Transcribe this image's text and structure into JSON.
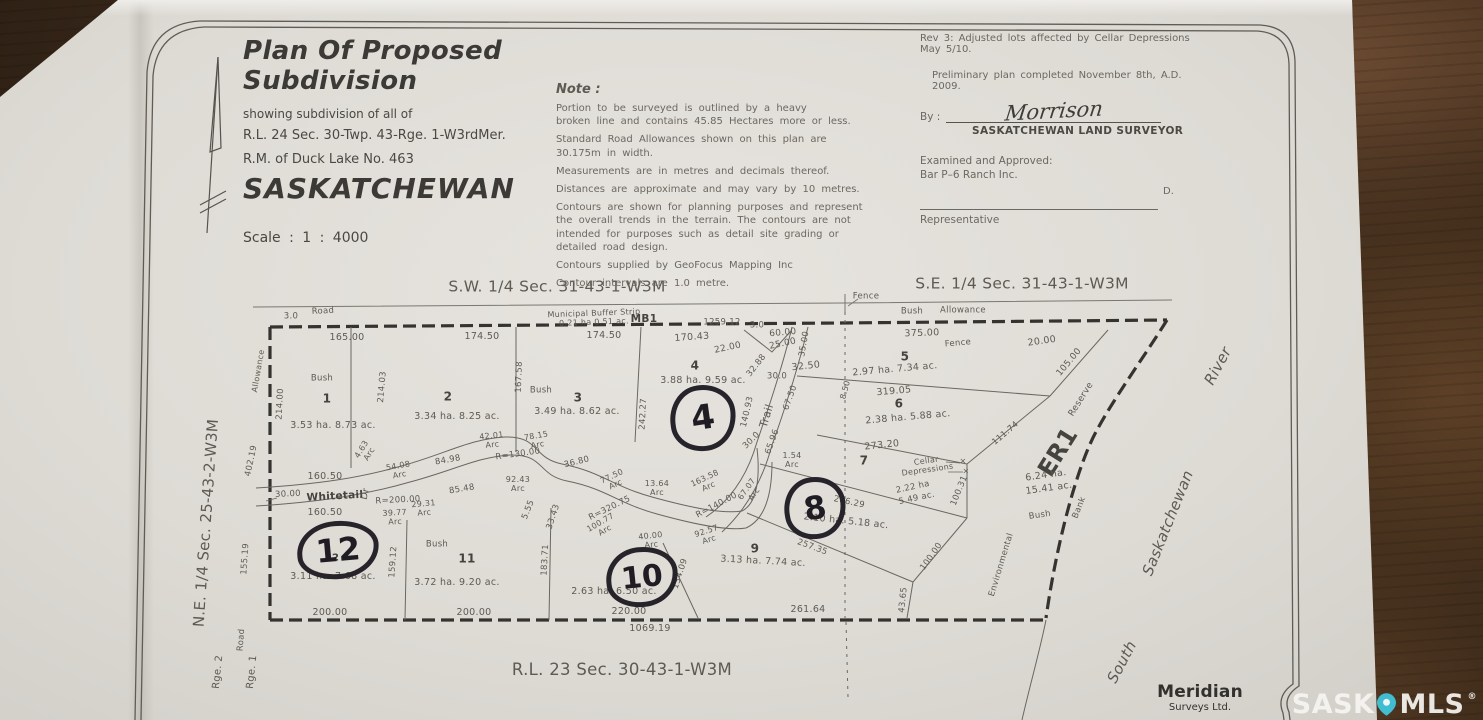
{
  "title_block": {
    "title": "Plan Of Proposed Subdivision",
    "line1": "showing subdivision of all of",
    "line2": "R.L. 24 Sec. 30-Twp. 43-Rge. 1-W3rdMer.",
    "line3": "R.M. of Duck Lake No. 463",
    "province": "SASKATCHEWAN",
    "scale": "Scale :  1 : 4000"
  },
  "notes": {
    "heading": "Note :",
    "items": [
      "Portion to be surveyed is outlined by a heavy\nbroken line and contains 45.85 Hectares more or less.",
      "Standard Road Allowances shown on this plan are\n30.175m in width.",
      "Measurements are in metres and decimals thereof.",
      "Distances are approximate and may vary by 10 metres.",
      "Contours are shown for planning purposes and represent\nthe overall trends in the terrain.  The contours are not\nintended for purposes such as detail site grading or\ndetailed road design.",
      "Contours supplied by GeoFocus Mapping Inc",
      "Contour intervals are 1.0 metre."
    ]
  },
  "approval": {
    "rev_note": "Rev 3:  Adjusted lots affected by Cellar Depressions May 5/10.",
    "prelim_note": "Preliminary plan completed November 8th, A.D. 2009.",
    "by_label": "By :",
    "signature": "Morrison",
    "surveyor_title": "SASKATCHEWAN LAND SURVEYOR",
    "examined": "Examined and Approved:\nBar P–6 Ranch Inc.",
    "representative_label": "Representative",
    "initial": "D."
  },
  "handwritten": {
    "lot4": "4",
    "lot8": "8",
    "lot10": "10",
    "lot12": "12"
  },
  "lots": [
    {
      "lot": "1",
      "area": "3.53 ha. 8.73 ac."
    },
    {
      "lot": "2",
      "area": "3.34 ha. 8.25 ac."
    },
    {
      "lot": "3",
      "area": "3.49 ha. 8.62 ac."
    },
    {
      "lot": "4",
      "area": "3.88 ha. 9.59 ac."
    },
    {
      "lot": "5",
      "area": "2.97 ha. 7.34 ac."
    },
    {
      "lot": "6",
      "area": "2.38 ha. 5.88 ac."
    },
    {
      "lot": "7",
      "area": "2.22 ha 5.49 ac."
    },
    {
      "lot": "8",
      "area": "2.10 ha. 5.18 ac."
    },
    {
      "lot": "9",
      "area": "3.13 ha. 7.74 ac."
    },
    {
      "lot": "10",
      "area": "2.63 ha. 6.50 ac."
    },
    {
      "lot": "11",
      "area": "3.72 ha. 9.20 ac."
    },
    {
      "lot": "12",
      "area": "3.11 ha. 7.68 ac."
    },
    {
      "lot": "MB1",
      "area": "0.21 ha  0.51 ac."
    },
    {
      "lot": "ER1",
      "area": "6.24 ha. 15.41 ac."
    }
  ],
  "footer": {
    "company_name": "Meridian",
    "company_sub": "Surveys Ltd.",
    "watermark": {
      "left": "SASK",
      "right": "MLS",
      "reg": "®",
      "pin_color": "#41bdd1"
    }
  },
  "plan": {
    "labels": [
      {
        "t": "S.W. 1/4 Sec. 31-43-1-W3M",
        "x": 557,
        "y": 287,
        "s": 15.5,
        "n": "label-sw-quarter"
      },
      {
        "t": "S.E. 1/4 Sec. 31-43-1-W3M",
        "x": 1022,
        "y": 284,
        "s": 15.5,
        "n": "label-se-quarter"
      },
      {
        "t": "N.E. 1/4 Sec. 25-43-2-W3M",
        "x": 206,
        "y": 523,
        "s": 15,
        "r": -86,
        "n": "label-ne-quarter"
      },
      {
        "t": "R.L. 23 Sec. 30-43-1-W3M",
        "x": 622,
        "y": 670,
        "s": 16.5,
        "n": "label-rl23"
      },
      {
        "t": "South",
        "x": 1122,
        "y": 662,
        "s": 15,
        "r": -62,
        "i": 1,
        "n": "label-river-south"
      },
      {
        "t": "Saskatchewan",
        "x": 1168,
        "y": 523,
        "s": 15,
        "r": -68,
        "i": 1,
        "n": "label-river-saskatchewan"
      },
      {
        "t": "River",
        "x": 1218,
        "y": 366,
        "s": 15,
        "r": -62,
        "i": 1,
        "n": "label-river-river"
      },
      {
        "t": "Fence",
        "x": 866,
        "y": 297,
        "s": 8.5
      },
      {
        "t": "Bush",
        "x": 912,
        "y": 312,
        "s": 8.5
      },
      {
        "t": "Allowance",
        "x": 963,
        "y": 311,
        "s": 8.5
      },
      {
        "t": "375.00",
        "x": 922,
        "y": 334,
        "s": 9.5,
        "r": -2
      },
      {
        "t": "Fence",
        "x": 958,
        "y": 344,
        "s": 8.5,
        "r": -5
      },
      {
        "t": "20.00",
        "x": 1042,
        "y": 342,
        "s": 9.5,
        "r": -8
      },
      {
        "t": "105.00",
        "x": 1070,
        "y": 363,
        "s": 9,
        "r": -50
      },
      {
        "t": "111.74",
        "x": 1006,
        "y": 434,
        "s": 8.5,
        "r": -40
      },
      {
        "t": "Reserve",
        "x": 1082,
        "y": 400,
        "s": 9,
        "r": -58
      },
      {
        "t": "ER1",
        "x": 1058,
        "y": 452,
        "s": 24,
        "r": -58,
        "b": 1,
        "n": "label-er1"
      },
      {
        "t": "6.24 ha.",
        "x": 1046,
        "y": 476,
        "s": 9.5,
        "r": -8
      },
      {
        "t": "15.41 ac.",
        "x": 1049,
        "y": 489,
        "s": 9.5,
        "r": -8
      },
      {
        "t": "Bush",
        "x": 1040,
        "y": 516,
        "s": 8.5,
        "r": -8
      },
      {
        "t": "Bank",
        "x": 1080,
        "y": 508,
        "s": 8.5,
        "r": -68
      },
      {
        "t": "Environmental",
        "x": 1002,
        "y": 565,
        "s": 8.5,
        "r": -73
      },
      {
        "t": "100.31",
        "x": 960,
        "y": 491,
        "s": 8.5,
        "r": -68
      },
      {
        "t": "100.00",
        "x": 932,
        "y": 557,
        "s": 8.5,
        "r": -55
      },
      {
        "t": "43.65",
        "x": 904,
        "y": 600,
        "s": 8.5,
        "r": -84
      },
      {
        "t": "3.0",
        "x": 291,
        "y": 317,
        "s": 8.5
      },
      {
        "t": "Road",
        "x": 323,
        "y": 312,
        "s": 8.5,
        "r": -3
      },
      {
        "t": "Municipal Buffer Strip",
        "x": 594,
        "y": 314,
        "s": 8,
        "r": -2
      },
      {
        "t": "0.21 ha  0.51 ac.",
        "x": 594,
        "y": 323,
        "s": 8,
        "r": -2
      },
      {
        "t": "MB1",
        "x": 644,
        "y": 320,
        "s": 10.5,
        "b": 1
      },
      {
        "t": "1259.12",
        "x": 722,
        "y": 323,
        "s": 8.5
      },
      {
        "t": "3.0",
        "x": 757,
        "y": 326,
        "s": 8.5
      },
      {
        "t": "165.00",
        "x": 347,
        "y": 338,
        "s": 9.5
      },
      {
        "t": "174.50",
        "x": 482,
        "y": 337,
        "s": 9.5
      },
      {
        "t": "174.50",
        "x": 604,
        "y": 336,
        "s": 9.5
      },
      {
        "t": "170.43",
        "x": 692,
        "y": 338,
        "s": 9.5,
        "r": -4
      },
      {
        "t": "22.00",
        "x": 728,
        "y": 349,
        "s": 9,
        "r": -12
      },
      {
        "t": "60.00",
        "x": 783,
        "y": 334,
        "s": 9,
        "r": -5
      },
      {
        "t": "25.00",
        "x": 783,
        "y": 345,
        "s": 9,
        "r": -12
      },
      {
        "t": "35.00",
        "x": 805,
        "y": 344,
        "s": 8.5,
        "r": -80
      },
      {
        "t": "32.50",
        "x": 806,
        "y": 367,
        "s": 9.5,
        "r": -6
      },
      {
        "t": "32.88",
        "x": 757,
        "y": 366,
        "s": 8.5,
        "r": -52
      },
      {
        "t": "30.0",
        "x": 777,
        "y": 377,
        "s": 8.5
      },
      {
        "t": "67.50",
        "x": 791,
        "y": 398,
        "s": 8.5,
        "r": -70
      },
      {
        "t": "Trail",
        "x": 767,
        "y": 416,
        "s": 11,
        "r": -73,
        "n": "label-trail"
      },
      {
        "t": "140.93",
        "x": 748,
        "y": 412,
        "s": 8.5,
        "r": -77
      },
      {
        "t": "30.0",
        "x": 752,
        "y": 441,
        "s": 8.5,
        "r": -45
      },
      {
        "t": "65.96",
        "x": 773,
        "y": 442,
        "s": 8.5,
        "r": -70
      },
      {
        "t": "1.54\nArc",
        "x": 792,
        "y": 461,
        "s": 8
      },
      {
        "t": "67.07\nArc",
        "x": 751,
        "y": 492,
        "s": 8,
        "r": -55
      },
      {
        "t": "8.50",
        "x": 846,
        "y": 390,
        "s": 8,
        "r": -75
      },
      {
        "t": "Bush",
        "x": 322,
        "y": 379,
        "s": 8.5
      },
      {
        "t": "1",
        "x": 327,
        "y": 399,
        "s": 12,
        "b": 1,
        "n": "label-lot-1"
      },
      {
        "t": "3.53 ha. 8.73 ac.",
        "x": 333,
        "y": 426,
        "s": 9.5
      },
      {
        "t": "214.00",
        "x": 281,
        "y": 404,
        "s": 8.5,
        "r": -87
      },
      {
        "t": "214.03",
        "x": 383,
        "y": 387,
        "s": 8.5,
        "r": -85
      },
      {
        "t": "2",
        "x": 448,
        "y": 397,
        "s": 12,
        "b": 1,
        "n": "label-lot-2"
      },
      {
        "t": "3.34 ha. 8.25 ac.",
        "x": 457,
        "y": 417,
        "s": 9.5
      },
      {
        "t": "167.58",
        "x": 520,
        "y": 377,
        "s": 8.5,
        "r": -88
      },
      {
        "t": "Bush",
        "x": 541,
        "y": 391,
        "s": 8.5
      },
      {
        "t": "3",
        "x": 578,
        "y": 398,
        "s": 12,
        "b": 1,
        "n": "label-lot-3"
      },
      {
        "t": "3.49 ha. 8.62 ac.",
        "x": 577,
        "y": 412,
        "s": 9.5
      },
      {
        "t": "4",
        "x": 695,
        "y": 366,
        "s": 12,
        "b": 1,
        "n": "label-lot-4"
      },
      {
        "t": "3.88 ha. 9.59 ac.",
        "x": 703,
        "y": 381,
        "s": 9.5
      },
      {
        "t": "242.27",
        "x": 644,
        "y": 414,
        "s": 8.5,
        "r": -87
      },
      {
        "t": "5",
        "x": 905,
        "y": 357,
        "s": 12,
        "b": 1,
        "n": "label-lot-5"
      },
      {
        "t": "2.97 ha. 7.34 ac.",
        "x": 895,
        "y": 370,
        "s": 9.5,
        "r": -5
      },
      {
        "t": "319.05",
        "x": 894,
        "y": 392,
        "s": 9.5,
        "r": -5
      },
      {
        "t": "6",
        "x": 899,
        "y": 404,
        "s": 12,
        "b": 1,
        "n": "label-lot-6"
      },
      {
        "t": "2.38 ha. 5.88 ac.",
        "x": 908,
        "y": 418,
        "s": 9.5,
        "r": -5
      },
      {
        "t": "273.20",
        "x": 882,
        "y": 446,
        "s": 9.5,
        "r": -6
      },
      {
        "t": "7",
        "x": 864,
        "y": 461,
        "s": 12,
        "b": 1,
        "n": "label-lot-7"
      },
      {
        "t": "Cellar\nDepressions",
        "x": 927,
        "y": 466,
        "s": 8,
        "r": -8
      },
      {
        "t": "2.22 ha",
        "x": 913,
        "y": 488,
        "s": 8.5,
        "r": -12
      },
      {
        "t": "5.49 ac.",
        "x": 917,
        "y": 499,
        "s": 8.5,
        "r": -12
      },
      {
        "t": "×",
        "x": 963,
        "y": 462,
        "s": 8
      },
      {
        "t": "×",
        "x": 966,
        "y": 472,
        "s": 8
      },
      {
        "t": "266.29",
        "x": 849,
        "y": 503,
        "s": 8.5,
        "r": 12
      },
      {
        "t": "2.10 ha. 5.18 ac.",
        "x": 846,
        "y": 522,
        "s": 9.5,
        "r": 6
      },
      {
        "t": "9",
        "x": 755,
        "y": 549,
        "s": 12,
        "b": 1,
        "n": "label-lot-9"
      },
      {
        "t": "3.13 ha. 7.74 ac.",
        "x": 763,
        "y": 562,
        "s": 9.5,
        "r": 3
      },
      {
        "t": "257.35",
        "x": 812,
        "y": 548,
        "s": 8.5,
        "r": 20
      },
      {
        "t": "92.57\nArc",
        "x": 708,
        "y": 536,
        "s": 8,
        "r": -18
      },
      {
        "t": "R=140.00",
        "x": 717,
        "y": 506,
        "s": 8.5,
        "r": -28
      },
      {
        "t": "163.58\nArc",
        "x": 707,
        "y": 483,
        "s": 8,
        "r": -25
      },
      {
        "t": "13.64\nArc",
        "x": 657,
        "y": 489,
        "s": 8
      },
      {
        "t": "R=320.75",
        "x": 610,
        "y": 509,
        "s": 8.5,
        "r": -26
      },
      {
        "t": "100.77\nArc",
        "x": 603,
        "y": 527,
        "s": 8,
        "r": -30
      },
      {
        "t": "40.00\nArc",
        "x": 651,
        "y": 541,
        "s": 8,
        "r": -6
      },
      {
        "t": "134.09",
        "x": 681,
        "y": 574,
        "s": 8.5,
        "r": -72
      },
      {
        "t": "4.63\nArc",
        "x": 366,
        "y": 452,
        "s": 8,
        "r": -58
      },
      {
        "t": "54.08\nArc",
        "x": 399,
        "y": 471,
        "s": 8,
        "r": -10
      },
      {
        "t": "84.98",
        "x": 448,
        "y": 461,
        "s": 8.5,
        "r": -10
      },
      {
        "t": "42.01\nArc",
        "x": 492,
        "y": 441,
        "s": 8,
        "r": -6
      },
      {
        "t": "78.15\nArc",
        "x": 537,
        "y": 441,
        "s": 8,
        "r": -10
      },
      {
        "t": "R=130.00",
        "x": 518,
        "y": 455,
        "s": 8.5,
        "r": -8
      },
      {
        "t": "36.80",
        "x": 577,
        "y": 463,
        "s": 8.5,
        "r": -14
      },
      {
        "t": "77.50\nArc",
        "x": 614,
        "y": 481,
        "s": 8,
        "r": -25
      },
      {
        "t": "92.43\nArc",
        "x": 518,
        "y": 485,
        "s": 8
      },
      {
        "t": "5.55",
        "x": 529,
        "y": 510,
        "s": 8.5,
        "r": -68
      },
      {
        "t": "33.43",
        "x": 554,
        "y": 517,
        "s": 8.5,
        "r": -72
      },
      {
        "t": "R=200.00",
        "x": 398,
        "y": 501,
        "s": 8.5,
        "r": -3
      },
      {
        "t": "29.31\nArc",
        "x": 424,
        "y": 509,
        "s": 8,
        "r": -5
      },
      {
        "t": "39.77\nArc",
        "x": 395,
        "y": 518,
        "s": 8,
        "r": -3
      },
      {
        "t": "85.48",
        "x": 462,
        "y": 490,
        "s": 8.5,
        "r": -9
      },
      {
        "t": "30.00",
        "x": 288,
        "y": 495,
        "s": 8.5,
        "r": -3
      },
      {
        "t": "Whitetail",
        "x": 335,
        "y": 497,
        "s": 10.5,
        "b": 1,
        "r": -3,
        "n": "label-whitetail"
      },
      {
        "t": "Dr",
        "x": 366,
        "y": 494,
        "s": 9.5,
        "r": -78
      },
      {
        "t": "160.50",
        "x": 325,
        "y": 477,
        "s": 9.5
      },
      {
        "t": "160.50",
        "x": 325,
        "y": 513,
        "s": 9.5
      },
      {
        "t": "12",
        "x": 332,
        "y": 558,
        "s": 10,
        "b": 1,
        "n": "label-lot-12"
      },
      {
        "t": "3.11 ha. 7.68 ac.",
        "x": 333,
        "y": 577,
        "s": 9.5
      },
      {
        "t": "159.12",
        "x": 394,
        "y": 562,
        "s": 8.5,
        "r": -86
      },
      {
        "t": "Bush",
        "x": 437,
        "y": 545,
        "s": 8.5
      },
      {
        "t": "11",
        "x": 467,
        "y": 559,
        "s": 12,
        "b": 1,
        "n": "label-lot-11"
      },
      {
        "t": "3.72 ha. 9.20 ac.",
        "x": 457,
        "y": 583,
        "s": 9.5
      },
      {
        "t": "183.71",
        "x": 546,
        "y": 560,
        "s": 8.5,
        "r": -87
      },
      {
        "t": "2.63 ha. 6.50 ac.",
        "x": 614,
        "y": 592,
        "s": 9.5
      },
      {
        "t": "200.00",
        "x": 330,
        "y": 613,
        "s": 9.5
      },
      {
        "t": "200.00",
        "x": 474,
        "y": 613,
        "s": 9.5
      },
      {
        "t": "220.00",
        "x": 629,
        "y": 612,
        "s": 9.5
      },
      {
        "t": "261.64",
        "x": 808,
        "y": 610,
        "s": 9.5
      },
      {
        "t": "1069.19",
        "x": 650,
        "y": 629,
        "s": 9.5
      },
      {
        "t": "Allowance",
        "x": 259,
        "y": 371,
        "s": 8,
        "r": -80
      },
      {
        "t": "402.19",
        "x": 252,
        "y": 461,
        "s": 8.5,
        "r": -78
      },
      {
        "t": "155.19",
        "x": 246,
        "y": 559,
        "s": 8.5,
        "r": -86
      },
      {
        "t": "Road",
        "x": 242,
        "y": 640,
        "s": 8.5,
        "r": -86
      },
      {
        "t": "Rge. 2",
        "x": 218,
        "y": 672,
        "s": 10,
        "r": -84,
        "n": "label-rge-2"
      },
      {
        "t": "Rge. 1",
        "x": 252,
        "y": 672,
        "s": 10,
        "r": -84,
        "n": "label-rge-1"
      }
    ]
  }
}
